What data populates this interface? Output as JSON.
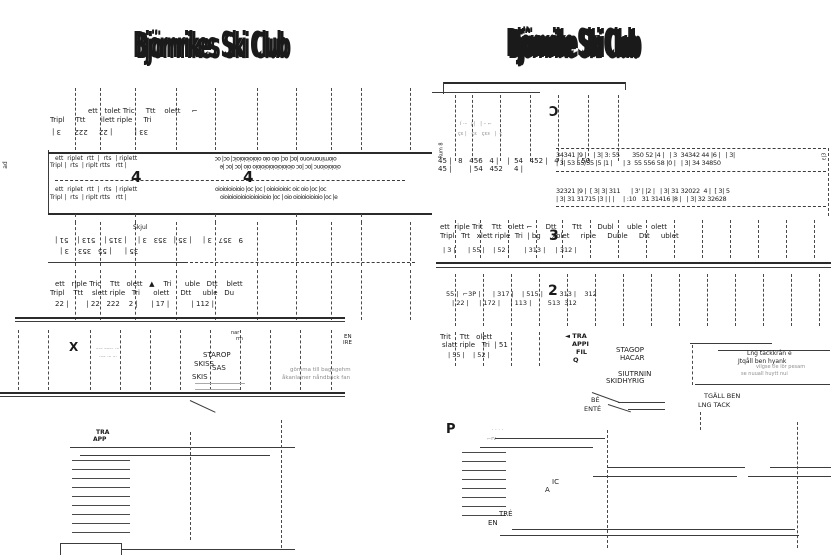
{
  "left": {
    "title": "Björnrikes Ski Club",
    "side_label": "ad",
    "rowA": {
      "labels1": "ett   tolet Tric     Ttt    olett     ⌐",
      "labels2": "Tripl     Ttt       ilett riple     Tri",
      "nums": "33 |          | 22     222      3 |"
    },
    "corridor": {
      "up1": "ett  riplet  rtt  |  rts  | riplett",
      "up2": "Tripl |  rts  | riplt rtts   rtt |",
      "up3": "oiominonvono |oc| oc| oio oio oioioioioioic| oc| oc",
      "up4": "oioioioionc |oc |oc oioioioioioioioioio oio |oc |oc |e",
      "floor": "4",
      "dn1": "ett  riplet  rtt  |  rts  | riplett",
      "dn2": "Tripl |  rts  | riplt rtts   rtt |",
      "dn3": "oioioioioioio |oc |oc | oioioioioic oic oio |oc |oc",
      "dn4": "oioioioioioioioioioioio |oc | oio oioioioioioio |oc |e"
    },
    "rowB": {
      "shed": "Skjul",
      "nums1": "9   357   3 |     | 35 |   353   3 |     | 315 |    513 |    51 |",
      "nums2": "35 |      | 55   353    3 |"
    },
    "rowC": {
      "labels1": "ett   riple Tric    Ttt   olett   ▲    Tri      uble   Dtt    blett",
      "labels2": "Tripl    Ttt    slett riple   Tri      olett     Dtt     uble   Du",
      "nums": "22 |        | 22   222    2 |      | 17 |          | 112 |"
    },
    "lower": {
      "x_mark": "X",
      "en": "EN",
      "ire": "IRE",
      "nar": "nar",
      "rrn": "rrn",
      "l1": "STAROP",
      "l2": "SKISS",
      "l3": "SAS",
      "l4": "SKIS",
      "gray1": "gömma till bagagehm",
      "gray2": "åkanlainer nåndbäck fan"
    },
    "stair_label": {
      "l1": "TRA",
      "l2": "APP"
    }
  },
  "right": {
    "title": "Björnrike Ski Club",
    "upper": {
      "mark": "Ɔ",
      "side": "Rum 8",
      "nums1": "45 |   8   456   4 |    |  54   452 |   4 |      | 50",
      "nums2": "45 |        | 54   452     4 |"
    },
    "grid": {
      "r1": "34341 |9 |    | 3| 3: 55       350 52 |4 |   | 3  34342 44 |6 |   | 3|",
      "r2": "| 3| 53 55/55 |5 |1 |      | 3  55 556 58 |0 |   | 3| 34 34850",
      "r3": "32321 |9 |  [ 3| 3| 311      | 3' | |2 |   | 3| 31 32022  4 |  [ 3| 5",
      "r4": "| 3| 31 31715 |3 | | |     | :10   31 31416 |8 |   | 3| 32 32628",
      "side": "ɛ|3"
    },
    "rowA": {
      "labels1": "ett  riple Trit    Ttt   olett ⌐      Dtt       Ttt       Dubl      uble    olett",
      "labels2": "Tripl   Trt   xlett riple  Tri  | bg     xblet     riple     Duble     Dtt     ublet",
      "floor": "3",
      "nums": "| 3 |      | 55 |    | 52 |       | 313 |     | 312 |"
    },
    "rowB": {
      "floor": "2",
      "nums1": "55 |  ⌐3P |      | 317 |    | 515 |        313 |    312",
      "nums2": "| 22 |     | 172 |     | 113 |        513  312"
    },
    "rowC": {
      "labels1": "Trit    Ttt   olett",
      "labels2": "slatt riple   Tri  | 51",
      "nums": "| 55 |    | 52 |",
      "stair": [
        "◄ TRA",
        "APPI",
        "FIL",
        "Q"
      ],
      "block": [
        "STAGOP",
        "HACAR",
        "SIUTRNIN",
        "SKIDHYRIG"
      ],
      "be": "BÉ",
      "entre": "ENTÉ"
    },
    "note": {
      "l1": "Lng tackkrån e",
      "l2": "Jtqåll ben hyank",
      "l3": "vilgse tle lör pesam",
      "l4": "se nuuall huytt nui",
      "t1": "TGÄLL BEN",
      "t2": "LNG TACK"
    },
    "lower": {
      "p": "P",
      "dots": "· · · ·",
      "rre": "⌐rv —",
      "ic": "IC",
      "a": "A",
      "tre": "TRÉ",
      "en": "EN"
    }
  }
}
